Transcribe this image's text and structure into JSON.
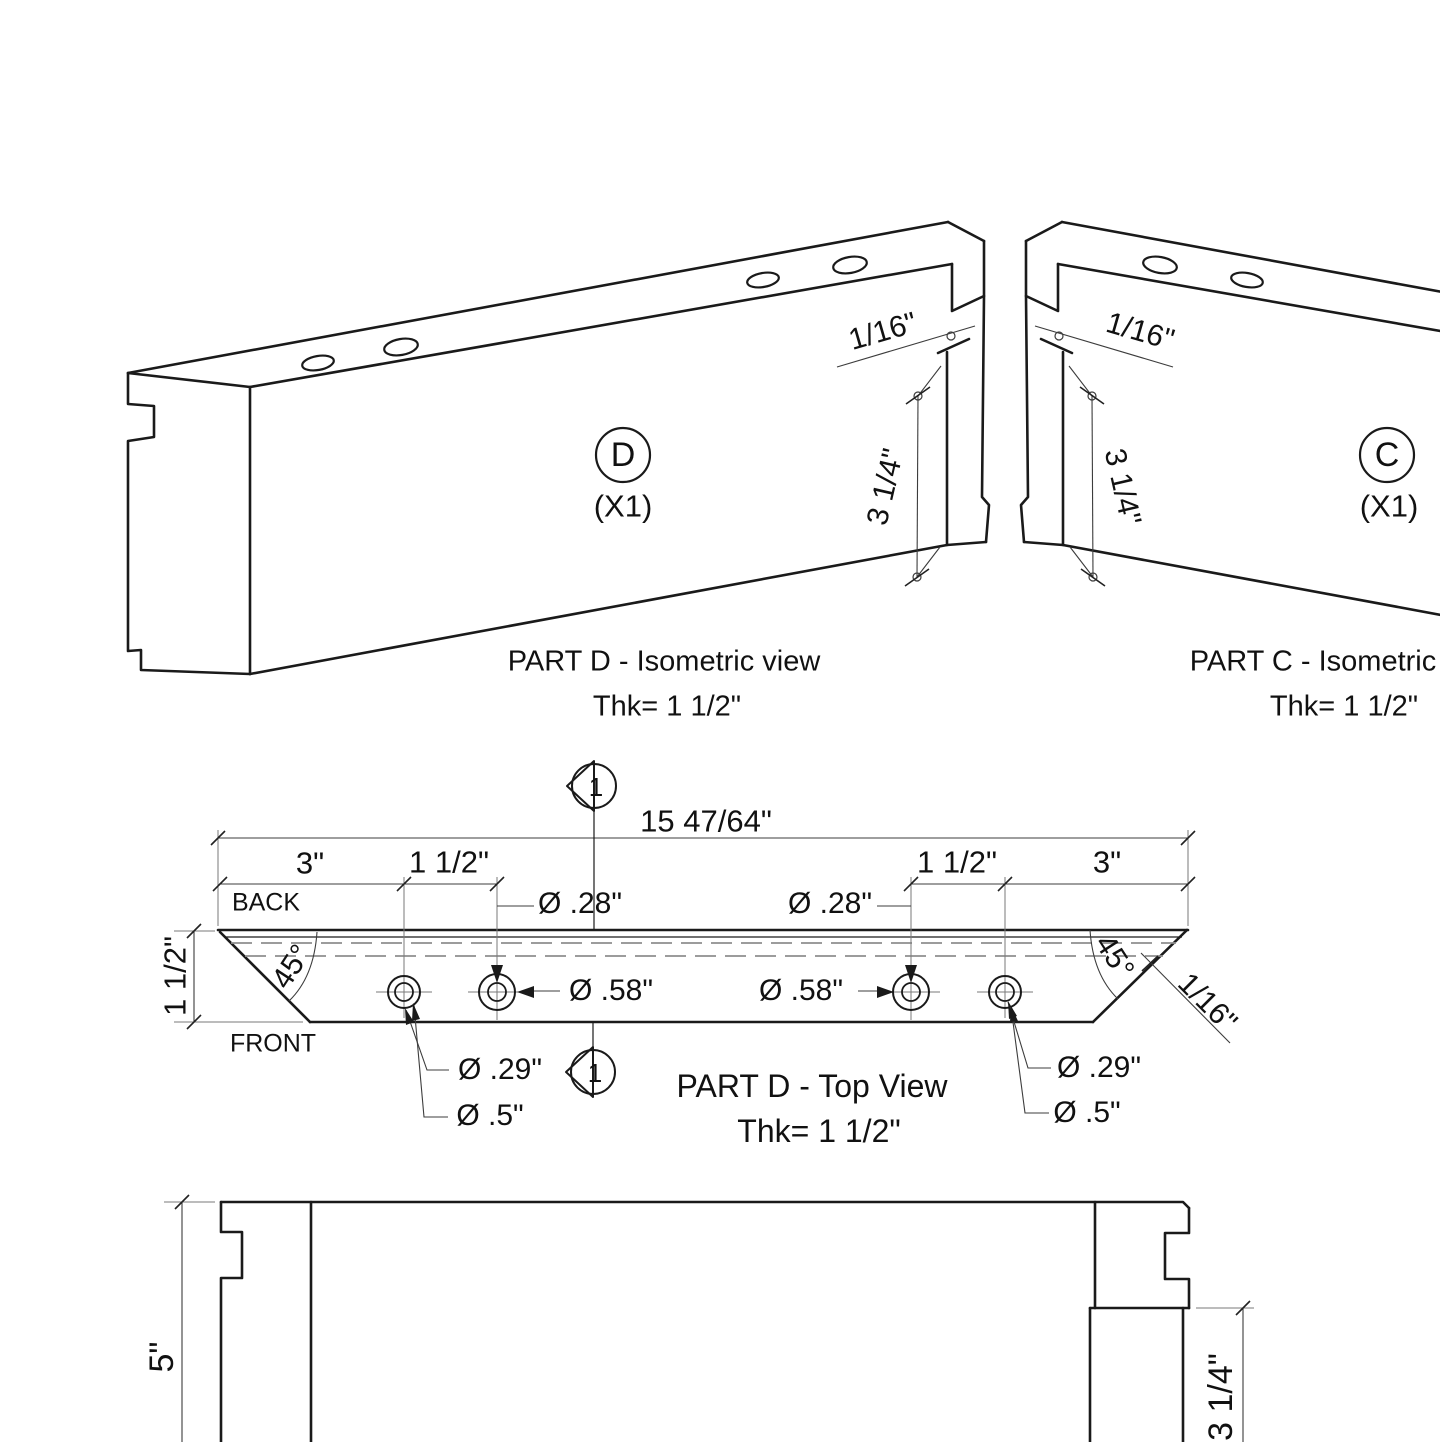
{
  "drawing": {
    "background": "#ffffff",
    "line_color": "#1a1a1a",
    "dim_color": "#3c3c3c",
    "hidden_line_color": "#8f8f8f",
    "views": {
      "iso_d": {
        "balloon": "D",
        "qty": "(X1)",
        "caption_line1": "PART D - Isometric view",
        "caption_line2": "Thk= 1 1/2\"",
        "dim_chamfer": "1/16\"",
        "dim_tenon": "3 1/4\""
      },
      "iso_c": {
        "balloon": "C",
        "qty": "(X1)",
        "caption_line1": "PART C - Isometric view",
        "caption_line2": "Thk= 1 1/2\"",
        "dim_chamfer": "1/16\"",
        "dim_tenon": "3 1/4\""
      },
      "top_view": {
        "caption_line1": "PART D - Top View",
        "caption_line2": "Thk= 1 1/2\"",
        "overall_length": "15 47/64\"",
        "dim_3_left": "3\"",
        "dim_1half_left": "1 1/2\"",
        "dim_1half_right": "1 1/2\"",
        "dim_3_right": "3\"",
        "label_back": "BACK",
        "label_front": "FRONT",
        "dim_thickness": "1 1/2\"",
        "angle_left": "45°",
        "angle_right": "45°",
        "dim_chamfer": "1/16\"",
        "dia_28_left": "Ø .28\"",
        "dia_28_right": "Ø .28\"",
        "dia_58_left": "Ø .58\"",
        "dia_58_right": "Ø .58\"",
        "dia_29_left": "Ø .29\"",
        "dia_29_right": "Ø .29\"",
        "dia_5_left": "Ø .5\"",
        "dia_5_right": "Ø .5\"",
        "section_marker": "1"
      },
      "front_view": {
        "dim_height": "5\"",
        "dim_tenon": "3 1/4\""
      }
    }
  }
}
